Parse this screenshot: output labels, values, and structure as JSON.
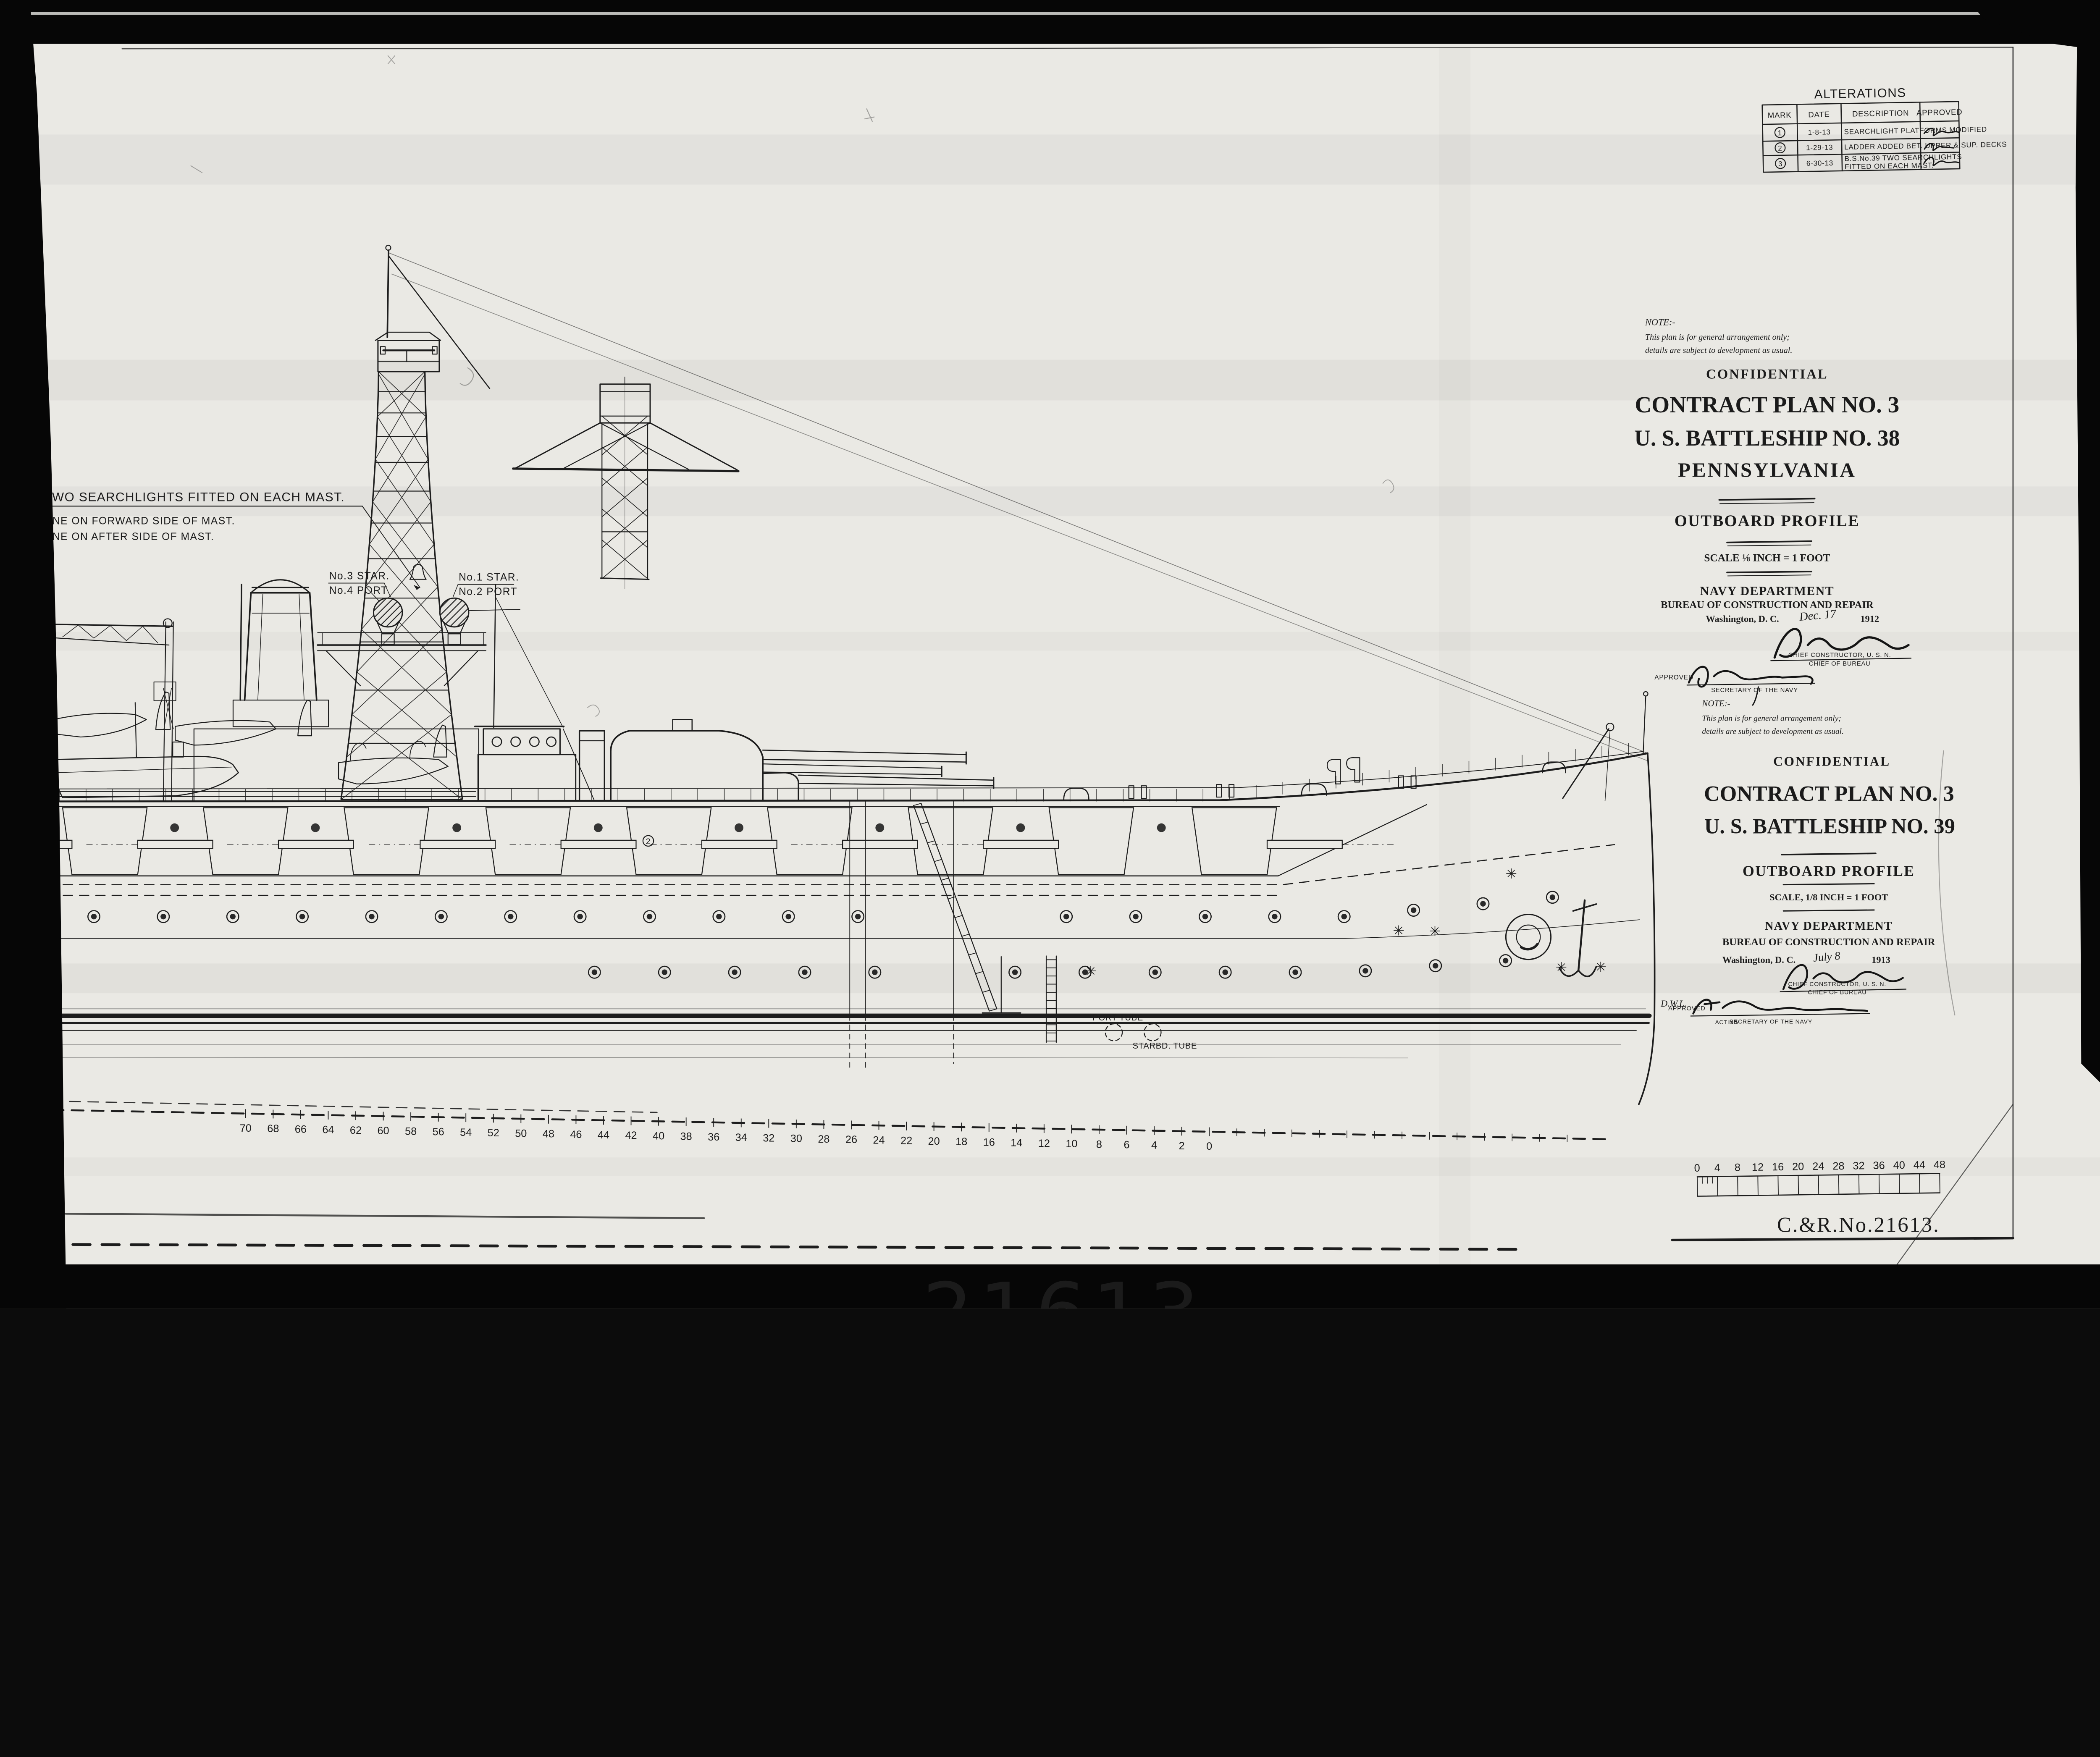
{
  "photo": {
    "bottom_number": "21613"
  },
  "alterations": {
    "title": "ALTERATIONS",
    "headers": {
      "mark": "MARK",
      "date": "DATE",
      "description": "DESCRIPTION",
      "approved": "APPROVED"
    },
    "rows": [
      {
        "mark": "1",
        "date": "1-8-13",
        "description": "SEARCHLIGHT PLATFORMS MODIFIED",
        "description2": "",
        "approved": "signature (illegible)"
      },
      {
        "mark": "2",
        "date": "1-29-13",
        "description": "LADDER ADDED BET. UPPER & SUP. DECKS",
        "description2": "",
        "approved": "signature (illegible)"
      },
      {
        "mark": "3",
        "date": "6-30-13",
        "description": "B.S.No.39 TWO SEARCHLIGHTS",
        "description2": "FITTED ON EACH MAST.",
        "approved": "signature (illegible)"
      }
    ]
  },
  "drawing_labels": {
    "searchlight_note_line1": "TWO SEARCHLIGHTS FITTED ON EACH MAST.",
    "searchlight_note_line2": "ONE ON FORWARD SIDE OF MAST.",
    "searchlight_note_line3": "ONE ON AFTER  SIDE OF MAST.",
    "mast_label_no3": "No.3 STAR.",
    "mast_label_no4": "No.4 PORT",
    "mast_label_no1": "No.1 STAR.",
    "mast_label_no2": "No.2 PORT",
    "port_tube": "PORT TUBE",
    "starbd_tube": "STARBD. TUBE",
    "dwl": "D.W.L.",
    "alteration_mark_2": "2",
    "station_numbers": [
      "70",
      "68",
      "66",
      "64",
      "62",
      "60",
      "58",
      "56",
      "54",
      "52",
      "50",
      "48",
      "46",
      "44",
      "42",
      "40",
      "38",
      "36",
      "34",
      "32",
      "30",
      "28",
      "26",
      "24",
      "22",
      "20",
      "18",
      "16",
      "14",
      "12",
      "10",
      "8",
      "6",
      "4",
      "2",
      "0"
    ]
  },
  "title_block_38": {
    "note_heading": "NOTE:-",
    "note_line1": "This plan is for general arrangement only;",
    "note_line2": "details are subject to development as usual.",
    "confidential": "CONFIDENTIAL",
    "plan": "CONTRACT PLAN NO. 3",
    "ship": "U. S. BATTLESHIP NO. 38",
    "name": "PENNSYLVANIA",
    "profile": "OUTBOARD PROFILE",
    "scale": "SCALE ⅛ INCH = 1 FOOT",
    "dept": "NAVY DEPARTMENT",
    "bureau": "BUREAU OF CONSTRUCTION AND REPAIR",
    "city": "Washington, D. C.",
    "date_hand": "Dec. 17",
    "year": "1912",
    "signed": "R. M. Watt (signature)",
    "chief1": "CHIEF CONSTRUCTOR, U. S. N.",
    "chief2": "CHIEF OF BUREAU",
    "approved": "APPROVED",
    "approved_signed": "G. v. L. Meyer (signature)",
    "secretary": "SECRETARY OF THE NAVY"
  },
  "title_block_39": {
    "note_heading": "NOTE:-",
    "note_line1": "This plan is for general arrangement only;",
    "note_line2": "details are subject to development as usual.",
    "confidential": "CONFIDENTIAL",
    "plan": "CONTRACT PLAN NO. 3",
    "ship": "U. S. BATTLESHIP NO. 39",
    "profile": "OUTBOARD PROFILE",
    "scale": "SCALE, 1/8 INCH = 1 FOOT",
    "dept": "NAVY DEPARTMENT",
    "bureau": "BUREAU OF CONSTRUCTION AND REPAIR",
    "city": "Washington, D. C.",
    "date_hand": "July 8",
    "year": "1913",
    "signed": "R. M. Watt (signature)",
    "chief1": "CHIEF CONSTRUCTOR, U. S. N.",
    "chief2": "CHIEF OF BUREAU",
    "approved": "APPROVED",
    "approved_signed": "F. D. Roosevelt (signature)",
    "acting": "ACTING",
    "secretary": "SECRETARY OF THE NAVY"
  },
  "scale_bar": {
    "numbers": [
      "0",
      "4",
      "8",
      "12",
      "16",
      "20",
      "24",
      "28",
      "32",
      "36",
      "40",
      "44",
      "48"
    ]
  },
  "stamp": "C.&R.No.21613."
}
